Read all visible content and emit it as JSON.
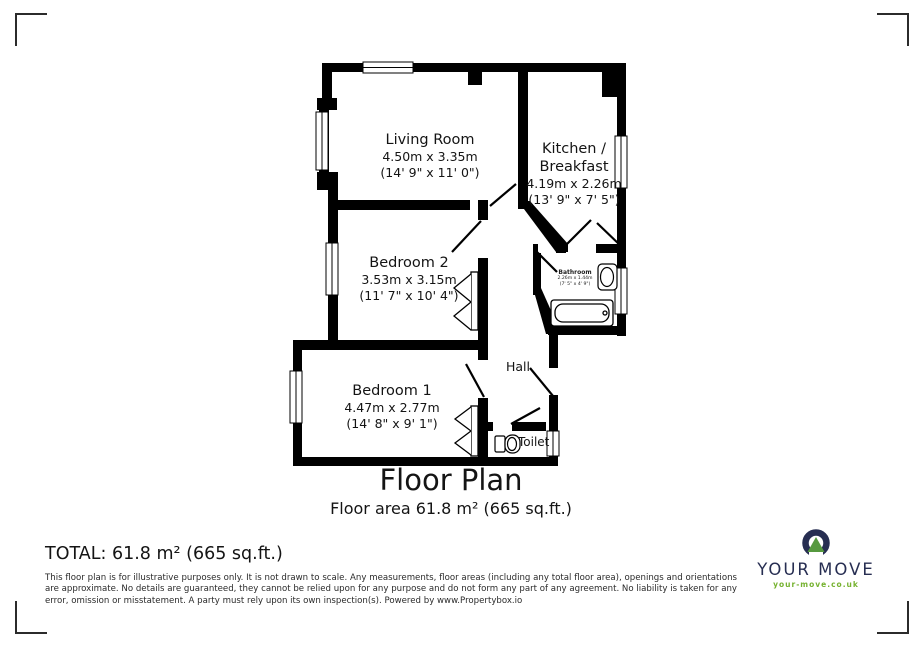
{
  "floorplan": {
    "wall_color": "#000000",
    "rooms": {
      "living_room": {
        "name": "Living Room",
        "metric": "4.50m x 3.35m",
        "imperial": "(14' 9\" x 11' 0\")"
      },
      "kitchen": {
        "name_line1": "Kitchen /",
        "name_line2": "Breakfast",
        "metric": "4.19m x 2.26m",
        "imperial": "(13' 9\" x 7' 5\")"
      },
      "bedroom2": {
        "name": "Bedroom 2",
        "metric": "3.53m x 3.15m",
        "imperial": "(11' 7\" x 10' 4\")"
      },
      "bathroom": {
        "name": "Bathroom",
        "metric": "2.26m x 1.44m",
        "imperial": "(7' 5\" x 4' 9\")"
      },
      "bedroom1": {
        "name": "Bedroom 1",
        "metric": "4.47m x 2.77m",
        "imperial": "(14' 8\" x 9' 1\")"
      },
      "hall": {
        "name": "Hall"
      },
      "toilet": {
        "name": "Toilet"
      }
    }
  },
  "title": {
    "heading": "Floor Plan",
    "subheading": "Floor area 61.8 m² (665 sq.ft.)"
  },
  "summary": {
    "total": "TOTAL: 61.8 m² (665 sq.ft.)"
  },
  "disclaimer": "This floor plan is for illustrative purposes only. It is not drawn to scale. Any measurements, floor areas (including any total floor area), openings and orientations are approximate. No details are guaranteed, they cannot be relied upon for any purpose and do not form any part of any agreement. No liability is taken for any error, omission or misstatement. A party must rely upon its own inspection(s). Powered by www.Propertybox.io",
  "logo": {
    "name": "YOUR MOVE",
    "url": "your-move.co.uk",
    "navy": "#272e52",
    "triangle_green": "#56993f",
    "url_green": "#76b230"
  }
}
